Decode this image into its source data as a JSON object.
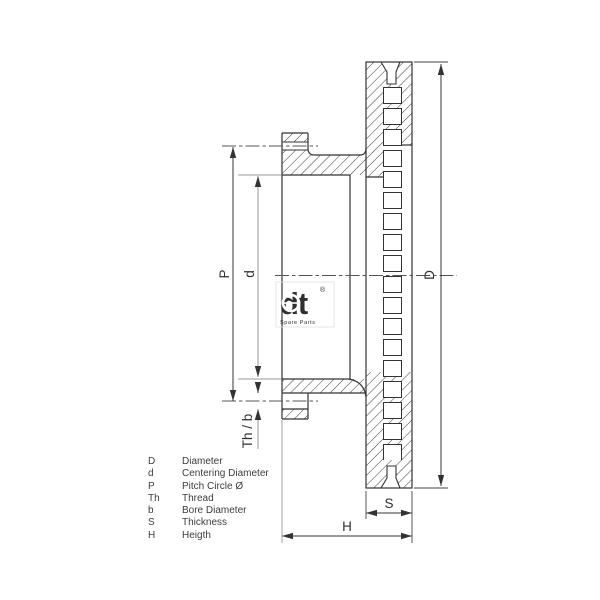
{
  "drawing": {
    "labels": {
      "pitch_circle": "P",
      "centering_diameter": "d",
      "thread_bore": "Th / b",
      "diameter": "D",
      "thickness": "S",
      "height": "H"
    }
  },
  "legend": {
    "rows": [
      {
        "key": "D",
        "label": "Diameter"
      },
      {
        "key": "d",
        "label": "Centering Diameter"
      },
      {
        "key": "P",
        "label": "Pitch Circle Ø"
      },
      {
        "key": "Th",
        "label": "Thread"
      },
      {
        "key": "b",
        "label": "Bore Diameter"
      },
      {
        "key": "S",
        "label": "Thickness"
      },
      {
        "key": "H",
        "label": "Heigth"
      }
    ]
  },
  "logo": {
    "text": "dt",
    "registered": "®",
    "subtext": "Spare Parts"
  },
  "colors": {
    "line": "#333333",
    "hatch": "#3a3a3a",
    "gray_line": "#999999",
    "watermark": "#b3b3b3"
  }
}
